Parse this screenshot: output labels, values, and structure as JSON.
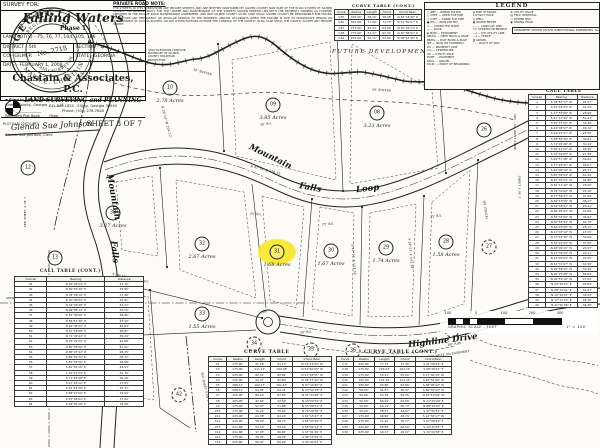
{
  "seal": {
    "state": "GEORGIA",
    "registered": "REGISTERED",
    "number": "No. 2718",
    "title": "LAND SURVEYOR",
    "name": "MARK E. CHASTAIN"
  },
  "filing": {
    "line1": "Filed in office Clerk of Superior Court",
    "line2": "Gilmer County, Georgia  ______ M",
    "line3": "Date: ______________",
    "line4": "Recorded Plat Book ____  Page ____",
    "signature": "Glenda Sue Johnson",
    "clerk": "Glenda Sue Johnson, Clerk"
  },
  "private_road_note": {
    "title": "PRIVATE ROAD NOTE:",
    "body": "THE STREETS IN THIS SUBDIVISION ARE PRIVATE STREETS AND ARE NEITHER MAINTAINED BY GILMER COUNTY NOR PART OF THE ROAD SYSTEM OF GILMER COUNTY. THE RESPONSIBILITY FOR THE UPKEEP AND MAINTENANCE OF THE STREETS SHOWN HEREON LIES WITH THE PROPERTY OWNERS AS FURTHER SPECIFIED IN THE PRIVATE ROAD MAINTENANCE AGREEMENT, AND NOT GILMER COUNTY. IN NO CASE SHALL GILMER COUNTY BE RESPONSIBLE FOR FAILING TO PROVIDE ANY EMERGENCY OR REGULAR SERVICE TO THE PROPERTY AND/OR OCCUPANTS WHEN THE FAILURE IS DUE TO INADEQUATE DESIGN OR MAINTENANCE OF ACCESS ROUTES, OR ANY OTHER FACTORS OUTSIDE THE CONTROL OF THE COUNTY. IN NO CASE SHALL THE COUNTY ACCEPT ANY PRIVATE STREET."
  },
  "contour_note": "3300' ELEVATION CONTOUR, BOUNDARY OF GILMER COUNTY MOUNTAIN PROTECTION",
  "future_development": "FUTURE DEVELOPMENT",
  "legend": {
    "title": "LEGEND",
    "col_a": [
      "○ RBF — REBAR FOUND",
      "○ OTPF — OPEN TOP PIPE",
      "○ CTPF — CRIMP TOP PIPE",
      "● IPS — IRON PIN SET",
      "× — COMPUTED POINT",
      "△ — ROCK",
      "▪ MON — MONUMENT",
      "DB/PG — DEED BOOK & PAGE",
      "PB/PG — PLAT BOOK & PAGE",
      "N/F — NOW OR FORMERLY",
      "P/L — PROPERTY LINE",
      "C/L — CENTERLINE",
      "UP — UTILITY POLE",
      "PVMT — PAVEMENT",
      "GRVL — GRAVEL",
      "P.O.B. — POINT OF BEGINNING"
    ],
    "col_b": [
      "◍ FIRE HYDRANT",
      "ø UTILITY POLE",
      "◎ WELL",
      "▣ WATER METER",
      "—··— LAND LOT LINE",
      "≈≈ STREAM OR BRANCH",
      "—o— O/H UTILITY LINE",
      "—×— FENCE",
      "▒ GRAVEL",
      "– – – RIGHT OF WAY"
    ],
    "col_c": [
      "⊗ UTILITY VALVE",
      "▤ TELE. PEDESTAL",
      "□ POWER BOX",
      "◉ SPRING HEAD"
    ],
    "note": "MONUMENT SHOWN ON R/W SUBDIVISIONAL DIMENSIONS. ALL IPS ARE 5/8\" REBAR UNLESS OTHERWISE NOTED."
  },
  "title_block": {
    "survey_for": "SURVEY FOR:",
    "name": "Falling Waters",
    "phase": "Phase 1",
    "land_lots": "LAND LOT(S) - 75, 76, 77, 104, 105, 106",
    "district": "DISTRICT - 5th",
    "section": "SECTION - 2nd",
    "county": "CO - GILMER",
    "state": "STATE - GEORGIA",
    "date": "DATE - FEBRUARY 1, 2008",
    "firm": "Chastain & Associates, P.C.",
    "firm_sub": "LAND SURVEYING and PLANNING",
    "address": "P.O. Box 1824 - Ellijay, Georgia 30540",
    "phone": "Phone: (706) 276-7628",
    "plot_file": "PLOT FILE: 2007/1/FF3",
    "sheet": "SHEET 3 OF 7"
  },
  "graphic_scale": {
    "labels": [
      "100",
      "0",
      "100",
      "200",
      "300"
    ],
    "caption": "GRAPHIC SCALE - FEET",
    "ratio": "1\" = 100'"
  },
  "land_lot_labels": [
    {
      "t": "L.L. 75",
      "x": 34,
      "y": 289
    },
    {
      "t": "L.L. 76",
      "x": 56,
      "y": 289
    },
    {
      "t": "L.L. 105",
      "x": 32,
      "y": 307
    },
    {
      "t": "L.L. 106",
      "x": 56,
      "y": 307
    }
  ],
  "lots": [
    {
      "n": "10",
      "x": 170,
      "y": 88,
      "acres": "2.78 Acres"
    },
    {
      "n": "09",
      "x": 273,
      "y": 105,
      "acres": "3.85 Acres"
    },
    {
      "n": "08",
      "x": 377,
      "y": 113,
      "acres": "3.23 Acres"
    },
    {
      "n": "38",
      "x": 113,
      "y": 213,
      "acres": "3.27 Acres"
    },
    {
      "n": "32",
      "x": 202,
      "y": 244,
      "acres": "2.67 Acres"
    },
    {
      "n": "31",
      "x": 277,
      "y": 252,
      "acres": "1.68 Acres",
      "highlight": true
    },
    {
      "n": "30",
      "x": 331,
      "y": 251,
      "acres": "1.67 Acres"
    },
    {
      "n": "29",
      "x": 386,
      "y": 248,
      "acres": "1.74 Acres"
    },
    {
      "n": "28",
      "x": 446,
      "y": 242,
      "acres": "1.58 Acres"
    },
    {
      "n": "33",
      "x": 202,
      "y": 314,
      "acres": "1.55 Acres"
    },
    {
      "n": "39",
      "x": 130,
      "y": 318,
      "acres": "1.79 Acres"
    },
    {
      "n": "12",
      "x": 28,
      "y": 168
    },
    {
      "n": "13",
      "x": 55,
      "y": 258
    },
    {
      "n": "14",
      "x": 68,
      "y": 317
    },
    {
      "n": "26",
      "x": 484,
      "y": 130
    },
    {
      "n": "27",
      "x": 489,
      "y": 247,
      "dashed": true
    },
    {
      "n": "34",
      "x": 254,
      "y": 344,
      "dashed": true
    },
    {
      "n": "35",
      "x": 311,
      "y": 350,
      "dashed": true
    },
    {
      "n": "36",
      "x": 353,
      "y": 351,
      "dashed": true
    },
    {
      "n": "37",
      "x": 452,
      "y": 330,
      "dashed": true
    },
    {
      "n": "42",
      "x": 179,
      "y": 395,
      "dashed": true
    }
  ],
  "road_labels": [
    {
      "t": "Mountain",
      "x": 90,
      "y": 192,
      "r": 80,
      "fs": 8.5
    },
    {
      "t": "Falls",
      "x": 103,
      "y": 247,
      "r": 85,
      "fs": 8.5
    },
    {
      "t": "Loop",
      "x": 111,
      "y": 318,
      "r": 88,
      "fs": 8.5
    },
    {
      "t": "Mountain",
      "x": 247,
      "y": 152,
      "r": 26,
      "fs": 8.5
    },
    {
      "t": "Falls",
      "x": 299,
      "y": 183,
      "r": 10,
      "fs": 8.5
    },
    {
      "t": "Loop",
      "x": 356,
      "y": 184,
      "r": -6,
      "fs": 8.5
    },
    {
      "t": "Highline  Drive",
      "x": 408,
      "y": 336,
      "r": -7,
      "fs": 8.5
    }
  ],
  "annotations": [
    {
      "t": "S 89°43'05\" E  135.42'",
      "x": 112,
      "y": 276,
      "r": 13
    },
    {
      "t": "50' BUFFER",
      "x": 193,
      "y": 70,
      "r": 16
    },
    {
      "t": "50' BUFFER",
      "x": 372,
      "y": 88,
      "r": 4
    },
    {
      "t": "4.5' BR",
      "x": 433,
      "y": 79,
      "r": -20
    },
    {
      "t": "25' B/L",
      "x": 322,
      "y": 222,
      "r": -4
    },
    {
      "t": "25' B/L",
      "x": 430,
      "y": 214,
      "r": -6
    },
    {
      "t": "25' B/L",
      "x": 250,
      "y": 212,
      "r": 6
    },
    {
      "t": "30' B/L",
      "x": 260,
      "y": 122,
      "r": -8
    },
    {
      "t": "20' B/L",
      "x": 300,
      "y": 330,
      "r": -4
    },
    {
      "t": "60' R/W",
      "x": 448,
      "y": 342,
      "r": -8
    },
    {
      "t": "SEE NOTE ON EASEMENT",
      "x": 428,
      "y": 352,
      "r": -8
    },
    {
      "t": "IPF (THICK)",
      "x": 476,
      "y": 208,
      "r": 80
    },
    {
      "t": "SPC - GA WEST ZONE",
      "x": 497,
      "y": 130,
      "r": 90
    },
    {
      "t": "SHEET 3 OF 7",
      "x": 508,
      "y": 185,
      "r": 90
    },
    {
      "t": "SEE SHEET 4 OF 7",
      "x": 190,
      "y": 385,
      "r": 78
    },
    {
      "t": "SEE SHEET 4 OF 7",
      "x": 10,
      "y": 210,
      "r": -90
    },
    {
      "t": "APPROX. 14.6'",
      "x": 6,
      "y": 296,
      "r": 0
    },
    {
      "t": "N 29°14' W  204.12'",
      "x": 150,
      "y": 120,
      "r": 75
    },
    {
      "t": "N 47°52' E  278.15'",
      "x": 250,
      "y": 168,
      "r": 14
    },
    {
      "t": "S 42°11' E  133.28'",
      "x": 338,
      "y": 258,
      "r": 85
    },
    {
      "t": "S 38°27' E  141.07'",
      "x": 395,
      "y": 252,
      "r": 85
    },
    {
      "t": "IPF",
      "x": 262,
      "y": 310,
      "r": 0
    }
  ],
  "tables": {
    "curve_table_top": {
      "title": "CURVE TABLE (CONT.)",
      "headers": [
        "Curve",
        "Radius",
        "Length",
        "Chord",
        "Chord Bear."
      ],
      "rows": [
        [
          "C45",
          "325.00'",
          "58.16'",
          "58.08'",
          "N 63°18'40\" E"
        ],
        [
          "C46",
          "325.00'",
          "71.90'",
          "71.75'",
          "N 51°50'27\" E"
        ],
        [
          "C47",
          "275.00'",
          "84.33'",
          "84.00'",
          "N 35°26'13\" E"
        ],
        [
          "C48",
          "275.00'",
          "62.47'",
          "62.34'",
          "N 20°08'51\" E"
        ],
        [
          "C49",
          "225.00'",
          "54.71'",
          "54.60'",
          "N 08°15'36\" E"
        ]
      ]
    },
    "curve_table": {
      "title": "CURVE TABLE",
      "headers": [
        "Curve",
        "Radius",
        "Length",
        "Chord",
        "Chord Bear."
      ],
      "rows": [
        [
          "C1",
          "175.00'",
          "21.18'",
          "21.17'",
          "N 74°23'03\" W"
        ],
        [
          "C2",
          "175.00'",
          "111.12'",
          "109.28'",
          "N 52°40'09\" W"
        ],
        [
          "C3",
          "225.00'",
          "82.51'",
          "82.04'",
          "N 41°02'55\" W"
        ],
        [
          "C4",
          "225.00'",
          "93.47'",
          "92.80'",
          "N 18°37'22\" W"
        ],
        [
          "C5",
          "288.11'",
          "102.17'",
          "101.63'",
          "N 07°15'40\" E"
        ],
        [
          "C6",
          "288.11'",
          "64.55'",
          "64.41'",
          "N 23°52'18\" E"
        ],
        [
          "C7",
          "325.00'",
          "88.10'",
          "87.83'",
          "N 31°44'06\" E"
        ],
        [
          "C8",
          "325.00'",
          "43.62'",
          "43.59'",
          "N 43°20'51\" E"
        ],
        [
          "C9",
          "175.00'",
          "52.07'",
          "51.88'",
          "N 55°08'12\" E"
        ],
        [
          "C10",
          "175.00'",
          "76.22'",
          "75.62'",
          "N 76°28'35\" E"
        ],
        [
          "C11",
          "225.00'",
          "64.38'",
          "64.16'",
          "S 81°15'47\" E"
        ],
        [
          "C12",
          "225.00'",
          "58.90'",
          "58.73'",
          "S 65°33'29\" E"
        ],
        [
          "C13",
          "411.86'",
          "54.19'",
          "54.16'",
          "S 58°02'14\" E"
        ],
        [
          "C14",
          "411.86'",
          "97.03'",
          "96.81'",
          "S 47°31'26\" E"
        ],
        [
          "C15",
          "175.00'",
          "39.44'",
          "39.36'",
          "S 38°15'58\" E"
        ],
        [
          "C16",
          "225.00'",
          "60.47'",
          "60.29'",
          "S 30°44'03\" E"
        ]
      ]
    },
    "curve_table_cont": {
      "title": "CURVE TABLE (CONT.)",
      "headers": [
        "Curve",
        "Radius",
        "Length",
        "Chord",
        "Chord Bear."
      ],
      "rows": [
        [
          "C17",
          "225.00'",
          "77.73'",
          "77.35'",
          "S 21°08'44\" E"
        ],
        [
          "C18",
          "175.00'",
          "103.64'",
          "102.14'",
          "S 08°26'31\" E"
        ],
        [
          "C19",
          "175.00'",
          "55.21'",
          "55.00'",
          "S 17°40'19\" W"
        ],
        [
          "C20",
          "750.00'",
          "121.38'",
          "121.25'",
          "S 29°52'06\" W"
        ],
        [
          "C21",
          "750.00'",
          "93.86'",
          "93.80'",
          "S 38°05'44\" W"
        ],
        [
          "C22",
          "50.00'",
          "41.57'",
          "40.37'",
          "S 66°31'27\" W"
        ],
        [
          "C23",
          "50.00'",
          "63.39'",
          "59.35'",
          "N 53°17'08\" W"
        ],
        [
          "C24",
          "50.00'",
          "66.94'",
          "62.09'",
          "N 21°25'40\" E"
        ],
        [
          "C25",
          "50.00'",
          "60.11'",
          "56.73'",
          "N 88°10'03\" E"
        ],
        [
          "C26",
          "25.00'",
          "38.27'",
          "34.67'",
          "S 47°22'51\" E"
        ],
        [
          "C27",
          "175.00'",
          "48.90'",
          "48.74'",
          "S 12°34'17\" W"
        ],
        [
          "C28",
          "175.00'",
          "71.26'",
          "70.77'",
          "S 07°08'29\" E"
        ],
        [
          "C29",
          "225.00'",
          "66.84'",
          "66.59'",
          "S 19°43'55\" E"
        ],
        [
          "C30",
          "225.00'",
          "49.17'",
          "49.07'",
          "S 34°29'38\" E"
        ]
      ]
    },
    "call_table": {
      "title": "CALL TABLE",
      "headers": [
        "Course",
        "Bearing",
        "Distance"
      ],
      "rows": [
        [
          "1",
          "S 38°42'17\" W",
          "35.67'"
        ],
        [
          "2",
          "S 52°18'33\" W",
          "42.15'"
        ],
        [
          "3",
          "S 47°55'08\" W",
          "28.90'"
        ],
        [
          "4",
          "S 61°12'44\" W",
          "51.23'"
        ],
        [
          "5",
          "S 55°37'20\" W",
          "33.48'"
        ],
        [
          "6",
          "S 49°08'57\" W",
          "46.72'"
        ],
        [
          "7",
          "S 64°25'11\" W",
          "24.56'"
        ],
        [
          "8",
          "S 58°50'39\" W",
          "39.81'"
        ],
        [
          "9",
          "S 71°03'26\" W",
          "30.14'"
        ],
        [
          "10",
          "S 66°41'52\" W",
          "44.95'"
        ],
        [
          "11",
          "S 74°19'05\" W",
          "27.38'"
        ],
        [
          "12",
          "S 69°57'48\" W",
          "36.62'"
        ],
        [
          "13",
          "S 77°24'31\" W",
          "48.07'"
        ],
        [
          "14",
          "S 81°08'16\" W",
          "25.73'"
        ],
        [
          "15",
          "S 85°36'54\" W",
          "41.29'"
        ],
        [
          "16",
          "N 87°45'23\" W",
          "34.86'"
        ],
        [
          "17",
          "N 82°11'49\" W",
          "29.50'"
        ],
        [
          "18",
          "N 78°33'02\" W",
          "45.18'"
        ],
        [
          "19",
          "N 73°59'37\" W",
          "31.94'"
        ],
        [
          "20",
          "N 69°16'55\" W",
          "38.27'"
        ],
        [
          "21",
          "N 64°48'21\" W",
          "26.41'"
        ],
        [
          "22",
          "N 60°05'43\" W",
          "43.66'"
        ],
        [
          "23",
          "N 55°31'09\" W",
          "35.02'"
        ],
        [
          "24",
          "N 50°53'34\" W",
          "40.78'"
        ],
        [
          "25",
          "N 46°20'58\" W",
          "28.13'"
        ],
        [
          "26",
          "N 41°47'12\" W",
          "47.55'"
        ],
        [
          "27",
          "N 37°14'36\" W",
          "32.69'"
        ],
        [
          "28",
          "N 32°41'50\" W",
          "37.84'"
        ],
        [
          "29",
          "N 28°09'15\" W",
          "26.97'"
        ],
        [
          "30",
          "N 23°36'29\" W",
          "49.21'"
        ],
        [
          "31",
          "N 19°03'53\" W",
          "33.15'"
        ],
        [
          "32",
          "N 14°31'07\" W",
          "42.58'"
        ],
        [
          "33",
          "N 09°58'32\" W",
          "30.46'"
        ],
        [
          "34",
          "N 05°25'46\" W",
          "36.09'"
        ],
        [
          "35",
          "N 00°53'10\" W",
          "27.62'"
        ],
        [
          "36",
          "N 03°39'25\" E",
          "45.84'"
        ],
        [
          "37",
          "N 08°12'01\" E",
          "31.27'"
        ],
        [
          "38",
          "N 12°44'47\" E",
          "39.53'"
        ],
        [
          "39",
          "N 17°17'23\" E",
          "28.76'"
        ],
        [
          "40",
          "N 21°50'08\" E",
          "34.40'"
        ]
      ]
    },
    "call_table_cont": {
      "title": "CALL TABLE (CONT.)",
      "headers": [
        "Course",
        "Bearing",
        "Distance"
      ],
      "rows": [
        [
          "41",
          "N 26°22'54\" E",
          "41.12'"
        ],
        [
          "42",
          "N 30°55'30\" E",
          "29.85'"
        ],
        [
          "43",
          "N 35°28'16\" E",
          "37.48'"
        ],
        [
          "44",
          "N 40°00'52\" E",
          "25.91'"
        ],
        [
          "45",
          "N 44°33'38\" E",
          "43.27'"
        ],
        [
          "46",
          "N 49°06'14\" E",
          "32.53'"
        ],
        [
          "47",
          "N 53°39'00\" E",
          "38.96'"
        ],
        [
          "48",
          "N 58°11'36\" E",
          "27.19'"
        ],
        [
          "49",
          "N 62°44'22\" E",
          "46.63'"
        ],
        [
          "50",
          "N 67°16'58\" E",
          "30.87'"
        ],
        [
          "51",
          "N 71°49'44\" E",
          "35.24'"
        ],
        [
          "52",
          "N 76°22'20\" E",
          "24.68'"
        ],
        [
          "53",
          "N 80°55'06\" E",
          "42.91'"
        ],
        [
          "54",
          "N 85°27'42\" E",
          "28.35'"
        ],
        [
          "55",
          "S 89°59'32\" E",
          "36.72'"
        ],
        [
          "56",
          "S 85°26'56\" E",
          "26.08'"
        ],
        [
          "57",
          "S 80°54'10\" E",
          "44.53'"
        ],
        [
          "58",
          "S 76°21'34\" E",
          "31.76'"
        ],
        [
          "59",
          "S 71°48'48\" E",
          "39.19'"
        ],
        [
          "60",
          "S 67°16'12\" E",
          "27.83'"
        ],
        [
          "61",
          "S 62°43'26\" E",
          "45.37'"
        ],
        [
          "62",
          "S 58°10'50\" E",
          "29.64'"
        ],
        [
          "63",
          "S 53°38'04\" E",
          "37.02'"
        ],
        [
          "64",
          "S 49°05'28\" E",
          "33.58'"
        ]
      ]
    }
  }
}
